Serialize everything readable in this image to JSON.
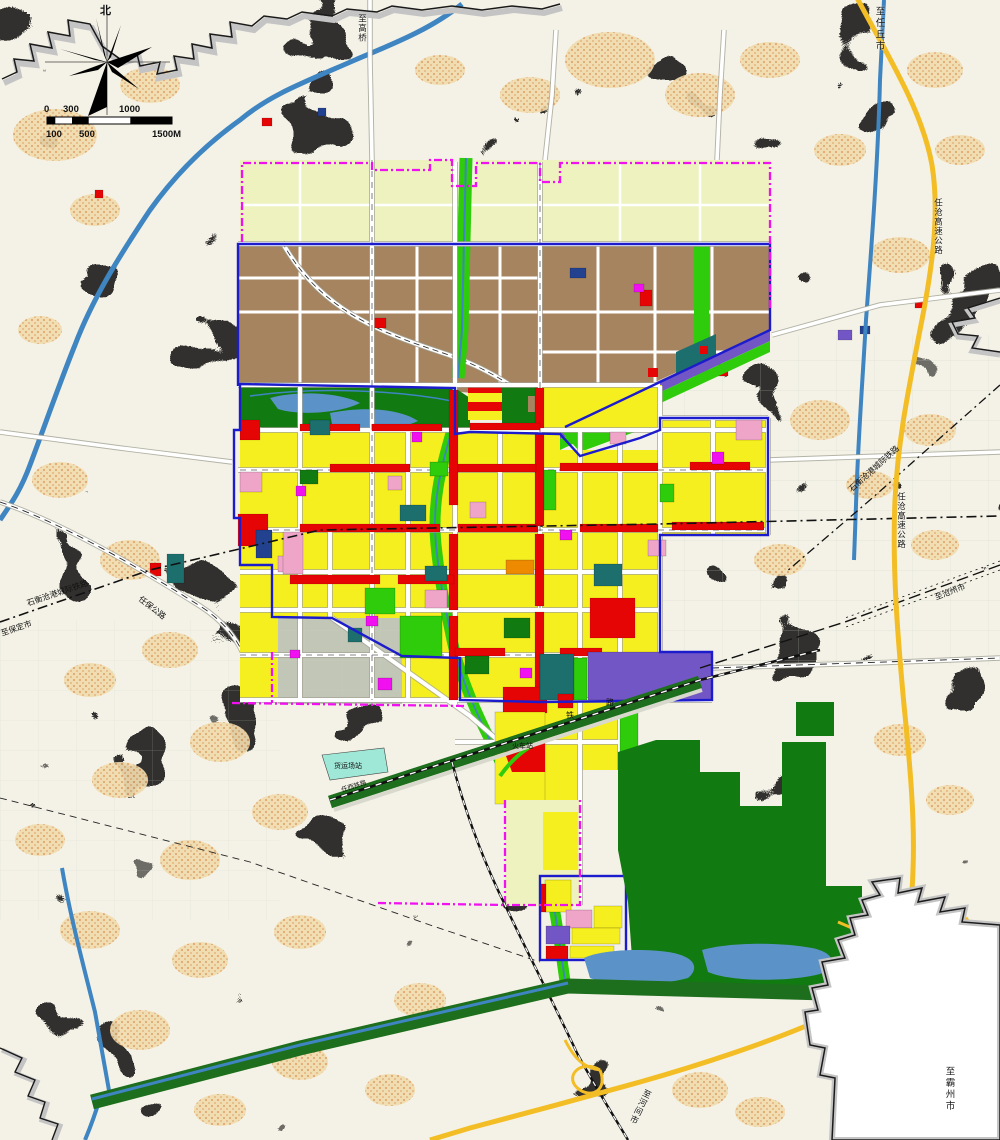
{
  "colors": {
    "bg": "#f4f2e6",
    "land_green": "#b7d2ab",
    "land_green_dark": "#8fbc88",
    "village_tan": "#f1dcae",
    "village_dot": "#dfa368",
    "water": "#3e85c2",
    "water_fill": "#5b93c8",
    "canal_green": "#1d6e1d",
    "road_white": "#ffffff",
    "road_casing": "#a3a396",
    "boundary_gray": "#c4c4c4",
    "boundary_black": "#1a1a1a",
    "magenta": "#f010f0",
    "blue_line": "#1c1ccc",
    "yellow": "#f6ef1f",
    "pale_reserve": "#eef2bf",
    "brown": "#a5845f",
    "red": "#e60505",
    "park_green": "#117a11",
    "bright_green": "#2ecc0a",
    "pink": "#efa5c8",
    "purple": "#7356c5",
    "navy": "#22418f",
    "teal": "#1d6f6d",
    "orange": "#ee8a00",
    "gray_parcel": "#c2c6b6",
    "highway": "#f3bd25",
    "rural_grid": "#c9d0c3",
    "aqua": "#9fe8d8"
  },
  "compass": {
    "north_label": "北"
  },
  "scale_bar": {
    "top": [
      "0",
      "300",
      "1000"
    ],
    "bottom": [
      "100",
      "500",
      "1500M"
    ]
  },
  "labels": {
    "to_renqiu": "至任丘市",
    "to_gaoqiao": "至高桥",
    "to_bazhou": "至霸州市",
    "to_baoding": "至保定市",
    "to_cangzhou": "至沧州市",
    "to_hejian": "至河间市",
    "intercity_rail": "石衡沧港城际铁路",
    "expressway": "任沧高速公路",
    "west_road": "任保公路",
    "railway_char_1": "铁",
    "railway_char_2": "路",
    "railway_name": "任西铁路",
    "station": "火车站",
    "freight_yard": "货运场站"
  }
}
